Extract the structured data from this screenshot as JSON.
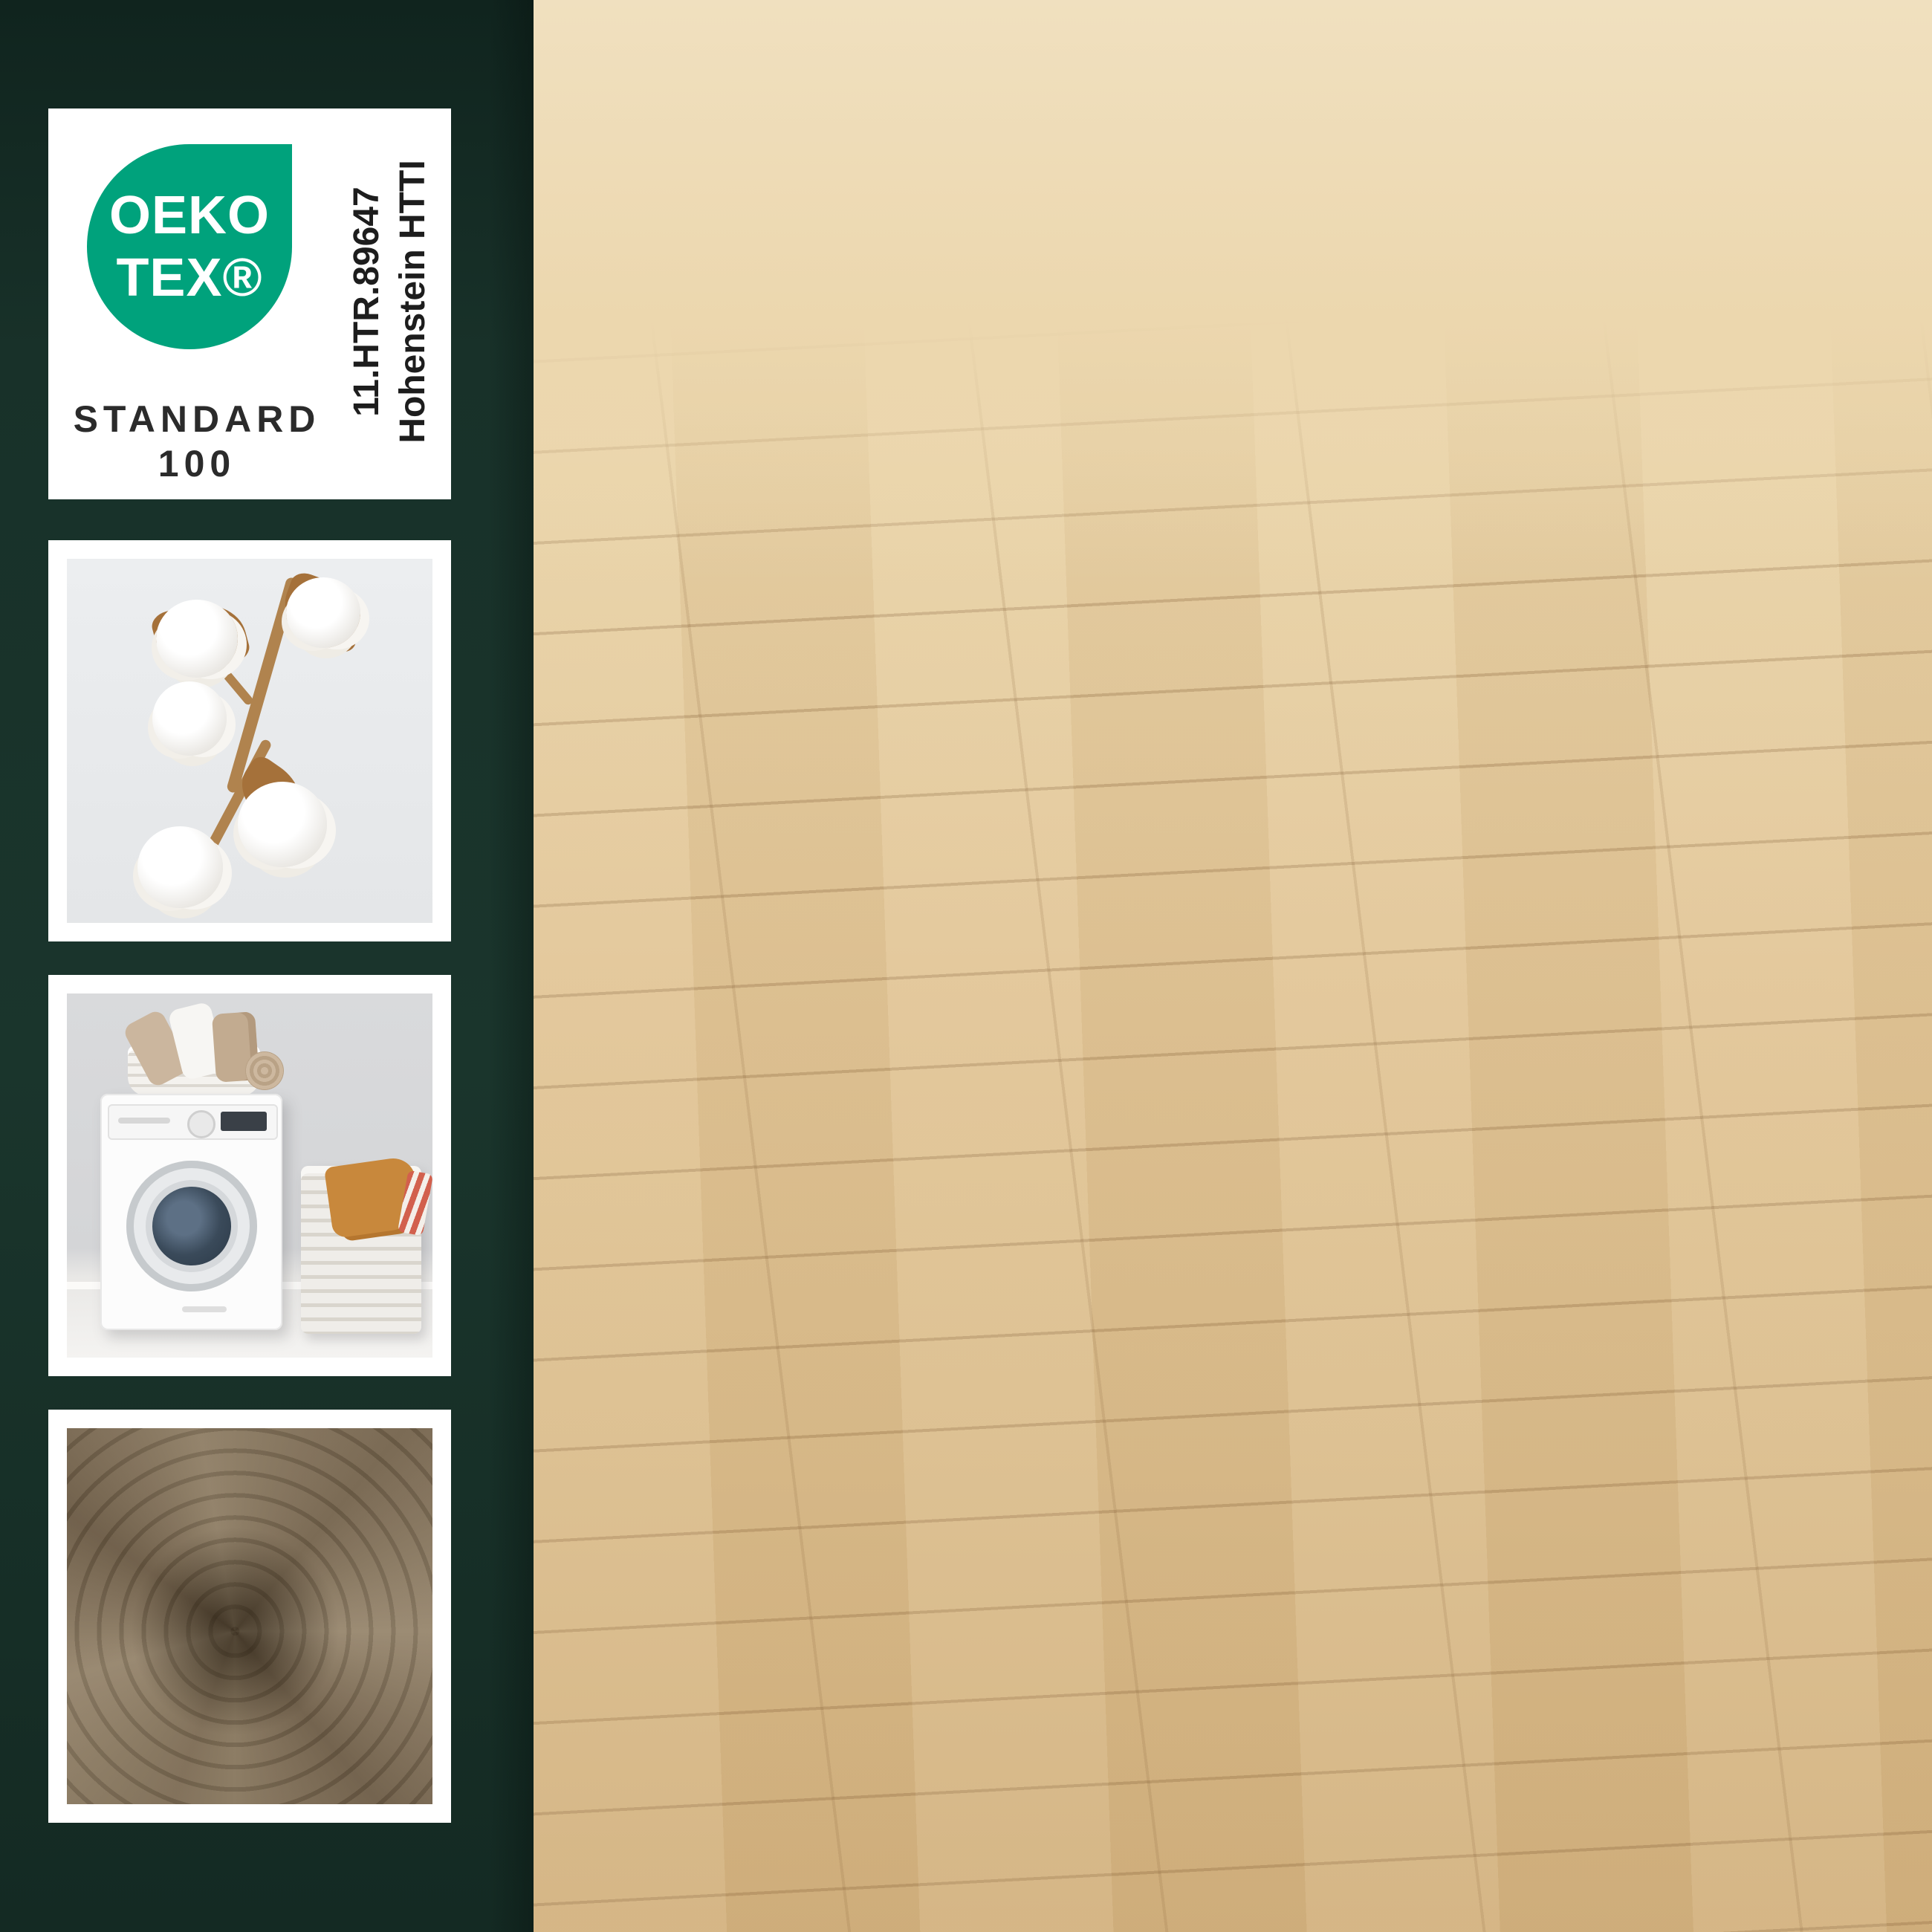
{
  "certification_card": {
    "logo_top": "OEKO",
    "logo_bottom": "TEX®",
    "standard_word": "STANDARD",
    "standard_number": "100",
    "certificate_number": "11.HTR.89647",
    "institute": "Hohenstein HTTI"
  },
  "feature_labels": [
    {
      "text": "OEKO-TEX® zertifiziert"
    },
    {
      "text": "100% Baumwolle"
    },
    {
      "text": "Waschbar bis 95°C"
    },
    {
      "text": "Dauerhaft strahlende Farben"
    }
  ],
  "sidebar_thumbnails": [
    "oeko-tex-standard-100-badge",
    "cotton-branch-photo",
    "washing-machine-photo",
    "towel-swirl-photo"
  ],
  "colors": {
    "sidebar_green": "#152e27",
    "oeko_teal": "#00a27c",
    "label_background": "#ffffff",
    "label_text": "#23100f",
    "mat_brown": "#87745a",
    "floor_wood": "#e2c697"
  }
}
